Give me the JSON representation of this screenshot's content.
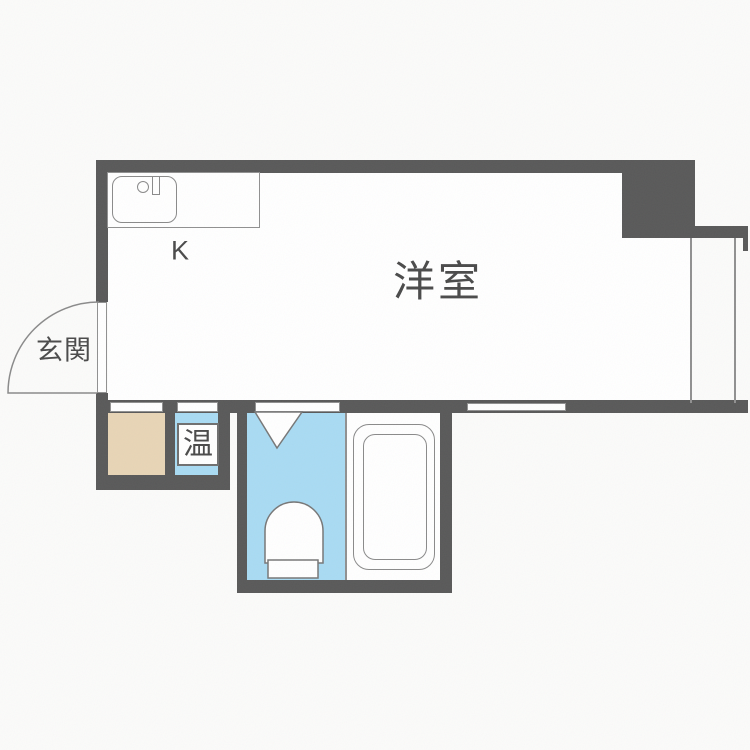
{
  "floorplan": {
    "title": "apartment-floor-plan",
    "labels": {
      "western_room": "洋室",
      "kitchen": "K",
      "entrance": "玄関",
      "water_heater": "温"
    },
    "fixtures": {
      "kitchen_sink": "sink-with-faucet",
      "bathtub": "bathtub",
      "toilet": "toilet",
      "entrance_door": "outward-swing-door",
      "toilet_door": "inward-swing-door"
    },
    "colors": {
      "wall": "#595959",
      "water_blue": "#a9dbf3",
      "entrance_floor": "#e8d5b6",
      "line": "#909090",
      "text": "#4a4a4a",
      "floor": "#ffffff",
      "bg": "#fbfbfa"
    }
  }
}
